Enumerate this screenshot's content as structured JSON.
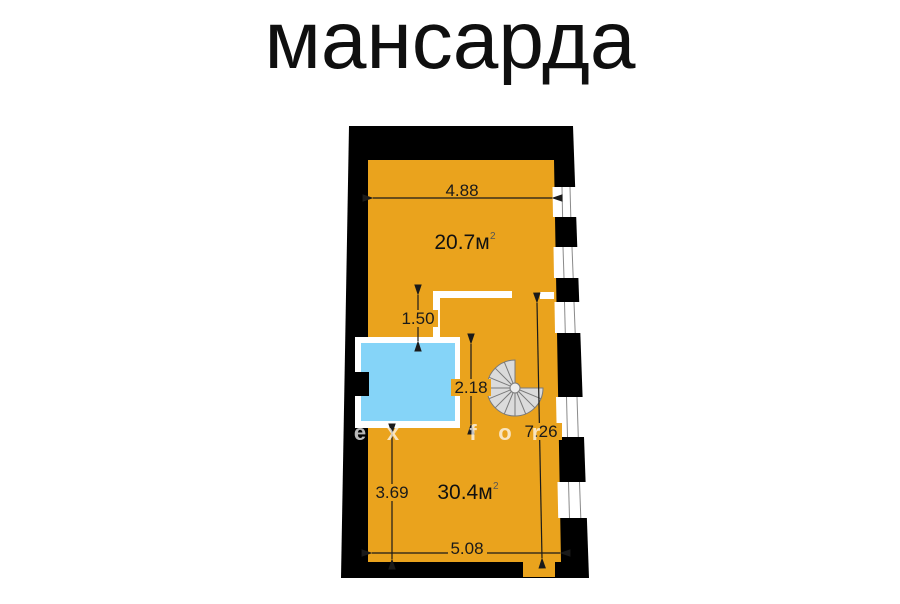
{
  "title": "мансарда",
  "plan": {
    "rooms": [
      {
        "area": "20.7м",
        "area_sup": "2"
      },
      {
        "area": "30.4м",
        "area_sup": "2"
      }
    ],
    "dims": {
      "top_width": "4.88",
      "partition_offset": "1.50",
      "opening_depth": "2.18",
      "right_length": "7.26",
      "lower_height": "3.69",
      "bottom_width": "5.08"
    },
    "watermark": [
      "e",
      "x",
      "f",
      "o",
      "r"
    ],
    "colors": {
      "wall": "#000000",
      "floor": "#EAA31D",
      "opening": "#85D4F8",
      "stair_fill": "#DBDBDB",
      "stair_line": "#7A7A7A",
      "dim_line": "#1A1A1A"
    }
  }
}
